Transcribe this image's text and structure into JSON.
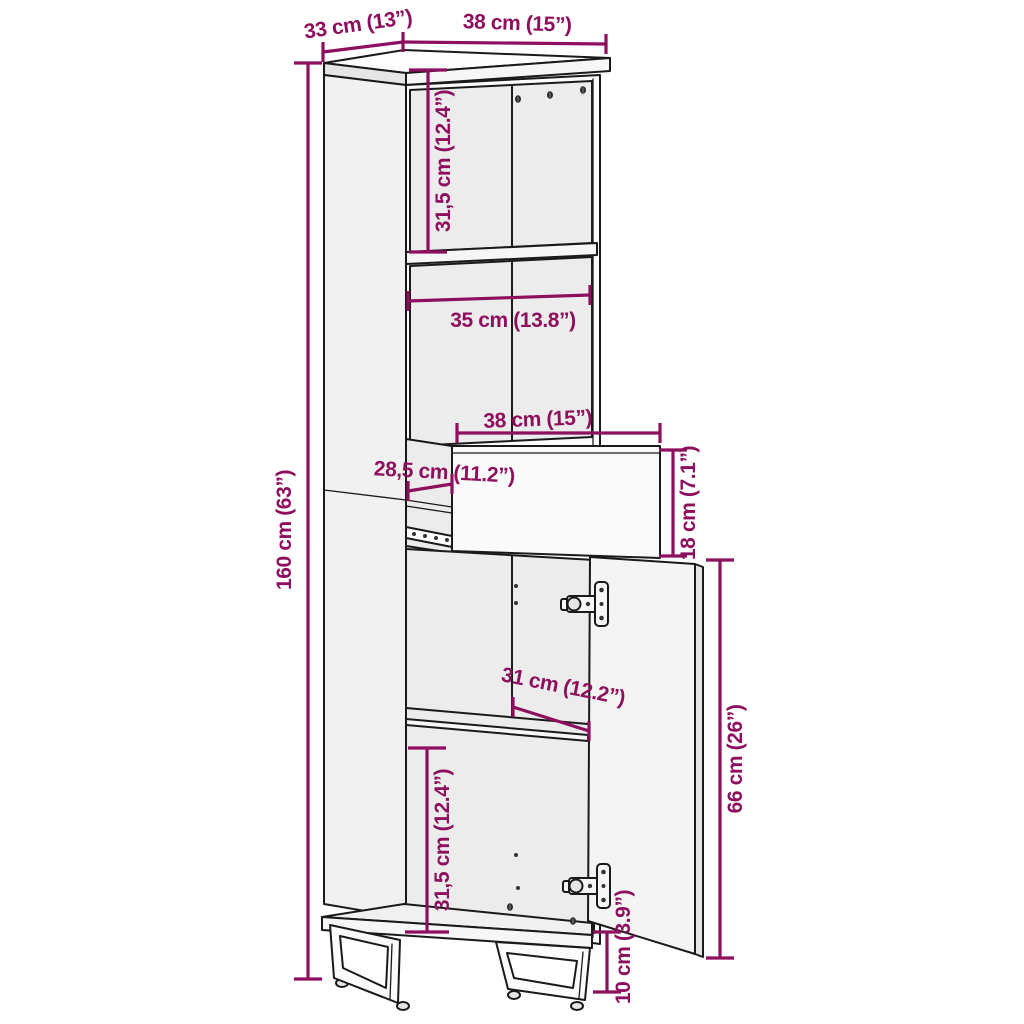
{
  "colors": {
    "dimension": "#8E0F5D",
    "line": "#1a1a1a",
    "background": "#ffffff"
  },
  "dims": {
    "depth_top": "33 cm (13”)",
    "width_top": "38 cm (15”)",
    "upper_inner_height": "31,5 cm (12.4”)",
    "inner_width": "35 cm (13.8”)",
    "drawer_width": "38 cm (15”)",
    "drawer_inner_depth": "28,5 cm (11.2”)",
    "drawer_height": "18 cm (7.1”)",
    "total_height": "160 cm (63”)",
    "shelf_depth": "31 cm (12.2”)",
    "door_height": "66 cm (26”)",
    "lower_inner_height": "31,5 cm (12.4”)",
    "leg_height": "10 cm (3.9”)"
  }
}
